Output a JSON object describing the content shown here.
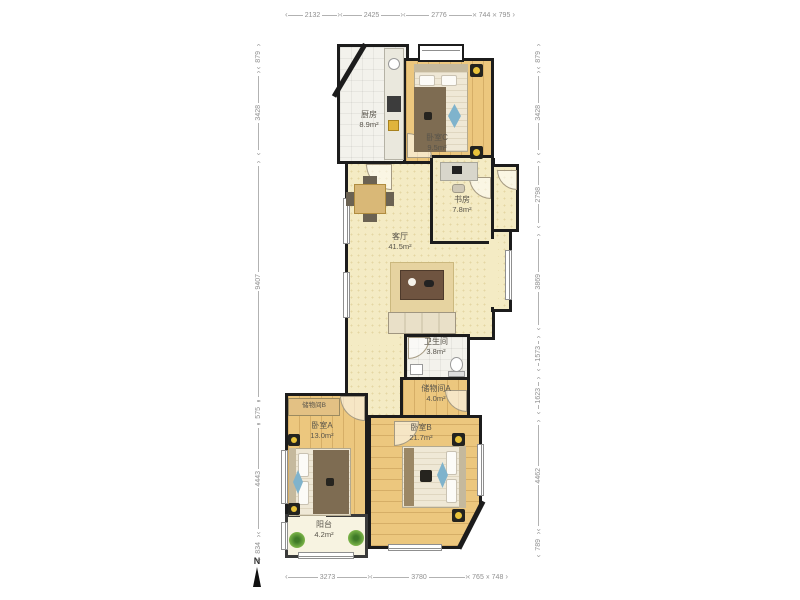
{
  "plan": {
    "rooms": {
      "kitchen": {
        "name": "厨房",
        "area": "8.9m²"
      },
      "bedroom_c": {
        "name": "卧室C",
        "area": "9.5m²"
      },
      "study": {
        "name": "书房",
        "area": "7.8m²"
      },
      "living": {
        "name": "客厅",
        "area": "41.5m²"
      },
      "bathroom": {
        "name": "卫生间",
        "area": "3.8m²"
      },
      "storage_a": {
        "name": "储物间A",
        "area": "4.0m²"
      },
      "storage_b": {
        "name": "储物间B"
      },
      "bedroom_a": {
        "name": "卧室A",
        "area": "13.0m²"
      },
      "bedroom_b": {
        "name": "卧室B",
        "area": "21.7m²"
      },
      "balcony": {
        "name": "阳台",
        "area": "4.2m²"
      }
    },
    "dimensions_mm": {
      "top": [
        "2132",
        "2425",
        "2776",
        "744",
        "795"
      ],
      "bottom": [
        "3273",
        "3780",
        "765",
        "748"
      ],
      "left": [
        "879",
        "3428",
        "9407",
        "575",
        "4443",
        "834"
      ],
      "right": [
        "879",
        "3428",
        "2798",
        "3869",
        "1573",
        "1623",
        "4462",
        "789"
      ]
    },
    "compass": {
      "label": "N"
    }
  },
  "colors": {
    "wall": "#1c1c1c",
    "wood_floor": "#ecc77e",
    "cream_floor": "#f4ebc4",
    "tile_floor": "#f3f2ec",
    "accent_blue": "#7fb3cc",
    "plant_green": "#69a33f",
    "nightstand_yellow": "#e8c23a"
  }
}
